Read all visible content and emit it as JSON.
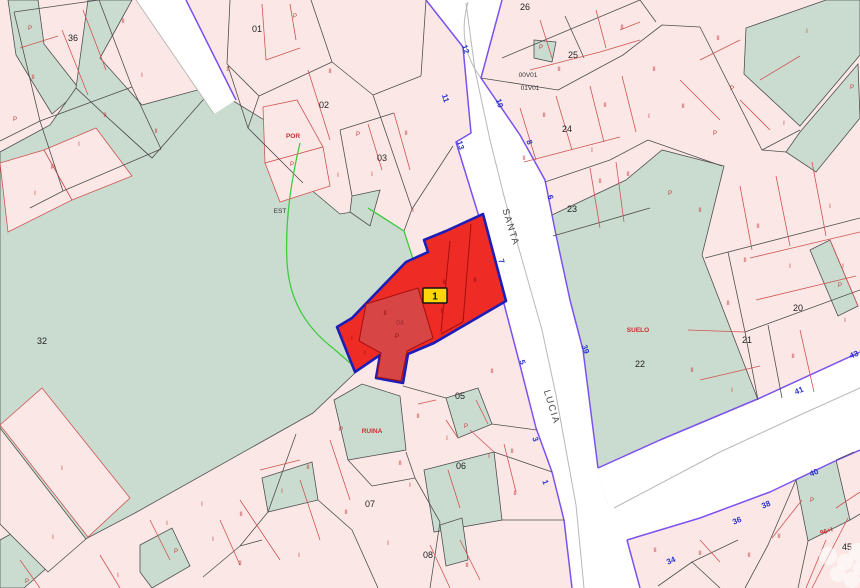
{
  "selected_parcel": {
    "badge": "1",
    "sub_code": "04"
  },
  "streets": [
    {
      "text": "SANTA",
      "x": 508,
      "y": 228,
      "angle": 73
    },
    {
      "text": "LUCIA",
      "x": 549,
      "y": 408,
      "angle": 73
    }
  ],
  "parcel_numbers": [
    {
      "text": "36",
      "x": 73,
      "y": 41
    },
    {
      "text": "01",
      "x": 257,
      "y": 32
    },
    {
      "text": "02",
      "x": 324,
      "y": 108
    },
    {
      "text": "03",
      "x": 382,
      "y": 161
    },
    {
      "text": "26",
      "x": 525,
      "y": 10
    },
    {
      "text": "25",
      "x": 573,
      "y": 58
    },
    {
      "text": "24",
      "x": 567,
      "y": 132
    },
    {
      "text": "23",
      "x": 572,
      "y": 212
    },
    {
      "text": "22",
      "x": 640,
      "y": 367
    },
    {
      "text": "21",
      "x": 747,
      "y": 343
    },
    {
      "text": "20",
      "x": 798,
      "y": 311
    },
    {
      "text": "32",
      "x": 42,
      "y": 344
    },
    {
      "text": "05",
      "x": 460,
      "y": 399
    },
    {
      "text": "06",
      "x": 461,
      "y": 469
    },
    {
      "text": "07",
      "x": 370,
      "y": 507
    },
    {
      "text": "08",
      "x": 428,
      "y": 558
    },
    {
      "text": "45",
      "x": 847,
      "y": 550
    }
  ],
  "house_numbers": [
    {
      "text": "12",
      "x": 463,
      "y": 50,
      "angle": 72
    },
    {
      "text": "11",
      "x": 443,
      "y": 99,
      "angle": 72
    },
    {
      "text": "13",
      "x": 458,
      "y": 146,
      "angle": 72
    },
    {
      "text": "10",
      "x": 497,
      "y": 104,
      "angle": 72
    },
    {
      "text": "8",
      "x": 527,
      "y": 143,
      "angle": 72
    },
    {
      "text": "6",
      "x": 548,
      "y": 198,
      "angle": 72
    },
    {
      "text": "7",
      "x": 499,
      "y": 262,
      "angle": 72
    },
    {
      "text": "5",
      "x": 520,
      "y": 363,
      "angle": 72
    },
    {
      "text": "39",
      "x": 583,
      "y": 350,
      "angle": 72
    },
    {
      "text": "3",
      "x": 533,
      "y": 440,
      "angle": 72
    },
    {
      "text": "1",
      "x": 543,
      "y": 483,
      "angle": 72
    },
    {
      "text": "43",
      "x": 855,
      "y": 357,
      "angle": -23
    },
    {
      "text": "41",
      "x": 800,
      "y": 393,
      "angle": -23
    },
    {
      "text": "40",
      "x": 815,
      "y": 475,
      "angle": -23
    },
    {
      "text": "38",
      "x": 767,
      "y": 507,
      "angle": -23
    },
    {
      "text": "36",
      "x": 738,
      "y": 523,
      "angle": -23
    },
    {
      "text": "34",
      "x": 672,
      "y": 563,
      "angle": -23
    }
  ],
  "black_labels": [
    {
      "text": "EST",
      "x": 280,
      "y": 213
    },
    {
      "text": "00V01",
      "x": 528,
      "y": 77
    },
    {
      "text": "01V01",
      "x": 530,
      "y": 90
    }
  ],
  "red_labels": [
    {
      "text": "POR",
      "x": 293,
      "y": 138
    },
    {
      "text": "RUINA",
      "x": 372,
      "y": 433
    },
    {
      "text": "SUELO",
      "x": 638,
      "y": 332
    },
    {
      "text": "96+I",
      "x": 827,
      "y": 533,
      "angle": -18
    }
  ],
  "annotations": [
    {
      "text": "P",
      "x": 30,
      "y": 30
    },
    {
      "text": "II",
      "x": 123,
      "y": 23
    },
    {
      "text": "II",
      "x": 33,
      "y": 79
    },
    {
      "text": "I",
      "x": 142,
      "y": 77
    },
    {
      "text": "II",
      "x": 105,
      "y": 117
    },
    {
      "text": "P",
      "x": 15,
      "y": 121
    },
    {
      "text": "I",
      "x": 79,
      "y": 146
    },
    {
      "text": "II",
      "x": 156,
      "y": 133
    },
    {
      "text": "P",
      "x": 53,
      "y": 169
    },
    {
      "text": "I",
      "x": 35,
      "y": 195
    },
    {
      "text": "II",
      "x": 228,
      "y": 71
    },
    {
      "text": "P",
      "x": 295,
      "y": 18
    },
    {
      "text": "II",
      "x": 330,
      "y": 73
    },
    {
      "text": "P",
      "x": 292,
      "y": 166
    },
    {
      "text": "P",
      "x": 358,
      "y": 136
    },
    {
      "text": "I",
      "x": 338,
      "y": 177
    },
    {
      "text": "I",
      "x": 372,
      "y": 176
    },
    {
      "text": "II",
      "x": 406,
      "y": 135
    },
    {
      "text": "I",
      "x": 413,
      "y": 212
    },
    {
      "text": "II",
      "x": 622,
      "y": 29
    },
    {
      "text": "P",
      "x": 541,
      "y": 49
    },
    {
      "text": "II",
      "x": 559,
      "y": 71
    },
    {
      "text": "II",
      "x": 654,
      "y": 71
    },
    {
      "text": "II",
      "x": 605,
      "y": 107
    },
    {
      "text": "I",
      "x": 649,
      "y": 118
    },
    {
      "text": "II",
      "x": 524,
      "y": 160
    },
    {
      "text": "I",
      "x": 592,
      "y": 152
    },
    {
      "text": "II",
      "x": 544,
      "y": 117
    },
    {
      "text": "II",
      "x": 600,
      "y": 183
    },
    {
      "text": "II",
      "x": 628,
      "y": 176
    },
    {
      "text": "P",
      "x": 670,
      "y": 195
    },
    {
      "text": "II",
      "x": 718,
      "y": 40
    },
    {
      "text": "I",
      "x": 807,
      "y": 33
    },
    {
      "text": "P",
      "x": 852,
      "y": 89
    },
    {
      "text": "II",
      "x": 683,
      "y": 108
    },
    {
      "text": "P",
      "x": 732,
      "y": 90
    },
    {
      "text": "I",
      "x": 784,
      "y": 125
    },
    {
      "text": "P",
      "x": 715,
      "y": 135
    },
    {
      "text": "I",
      "x": 830,
      "y": 208
    },
    {
      "text": "II",
      "x": 758,
      "y": 228
    },
    {
      "text": "P",
      "x": 840,
      "y": 287
    },
    {
      "text": "I",
      "x": 843,
      "y": 268
    },
    {
      "text": "II",
      "x": 700,
      "y": 212
    },
    {
      "text": "II",
      "x": 745,
      "y": 262
    },
    {
      "text": "I",
      "x": 790,
      "y": 268
    },
    {
      "text": "II",
      "x": 728,
      "y": 305
    },
    {
      "text": "I",
      "x": 845,
      "y": 322
    },
    {
      "text": "II",
      "x": 692,
      "y": 372
    },
    {
      "text": "I",
      "x": 732,
      "y": 392
    },
    {
      "text": "II",
      "x": 793,
      "y": 358
    },
    {
      "text": "II",
      "x": 492,
      "y": 373
    },
    {
      "text": "II",
      "x": 418,
      "y": 418
    },
    {
      "text": "P",
      "x": 341,
      "y": 431
    },
    {
      "text": "P",
      "x": 466,
      "y": 428
    },
    {
      "text": "I",
      "x": 447,
      "y": 440
    },
    {
      "text": "II",
      "x": 400,
      "y": 465
    },
    {
      "text": "I",
      "x": 410,
      "y": 487
    },
    {
      "text": "II",
      "x": 512,
      "y": 453
    },
    {
      "text": "I",
      "x": 489,
      "y": 458
    },
    {
      "text": "II",
      "x": 515,
      "y": 495
    },
    {
      "text": "II",
      "x": 467,
      "y": 567
    },
    {
      "text": "I",
      "x": 388,
      "y": 545
    },
    {
      "text": "I",
      "x": 202,
      "y": 506
    },
    {
      "text": "II",
      "x": 241,
      "y": 516
    },
    {
      "text": "I",
      "x": 213,
      "y": 541
    },
    {
      "text": "II",
      "x": 240,
      "y": 565
    },
    {
      "text": "I",
      "x": 282,
      "y": 493
    },
    {
      "text": "I",
      "x": 299,
      "y": 557
    },
    {
      "text": "II",
      "x": 346,
      "y": 514
    },
    {
      "text": "II",
      "x": 308,
      "y": 469
    },
    {
      "text": "I",
      "x": 62,
      "y": 470
    },
    {
      "text": "I",
      "x": 167,
      "y": 525
    },
    {
      "text": "P",
      "x": 176,
      "y": 553
    },
    {
      "text": "I",
      "x": 118,
      "y": 577
    },
    {
      "text": "I",
      "x": 53,
      "y": 539
    },
    {
      "text": "P",
      "x": 27,
      "y": 583
    },
    {
      "text": "P",
      "x": 812,
      "y": 502
    },
    {
      "text": "II",
      "x": 779,
      "y": 538
    },
    {
      "text": "II",
      "x": 749,
      "y": 557
    },
    {
      "text": "II",
      "x": 655,
      "y": 552
    },
    {
      "text": "II",
      "x": 700,
      "y": 555
    },
    {
      "text": "II",
      "x": 444,
      "y": 284,
      "variant": "dark"
    },
    {
      "text": "II",
      "x": 442,
      "y": 313,
      "variant": "dark"
    },
    {
      "text": "II",
      "x": 385,
      "y": 315,
      "variant": "dark"
    },
    {
      "text": "P",
      "x": 397,
      "y": 338,
      "variant": "dark"
    },
    {
      "text": "I",
      "x": 365,
      "y": 355,
      "variant": "dark"
    },
    {
      "text": "II",
      "x": 475,
      "y": 282,
      "variant": "dark"
    },
    {
      "text": "I",
      "x": 352,
      "y": 340,
      "variant": "dark"
    }
  ],
  "colors": {
    "parcel_pink": "#fbe8e6",
    "parcel_green": "#cadcd0",
    "road_white": "#ffffff",
    "road_edge_purple": "#7b52ee",
    "boundary_gray": "#4f4f4f",
    "subparcel_red": "#d05454",
    "selected_fill": "#ee2b25",
    "selected_outline": "#1d1db8",
    "badge_yellow": "#ffd60a",
    "house_number_blue": "#2a35cc"
  }
}
